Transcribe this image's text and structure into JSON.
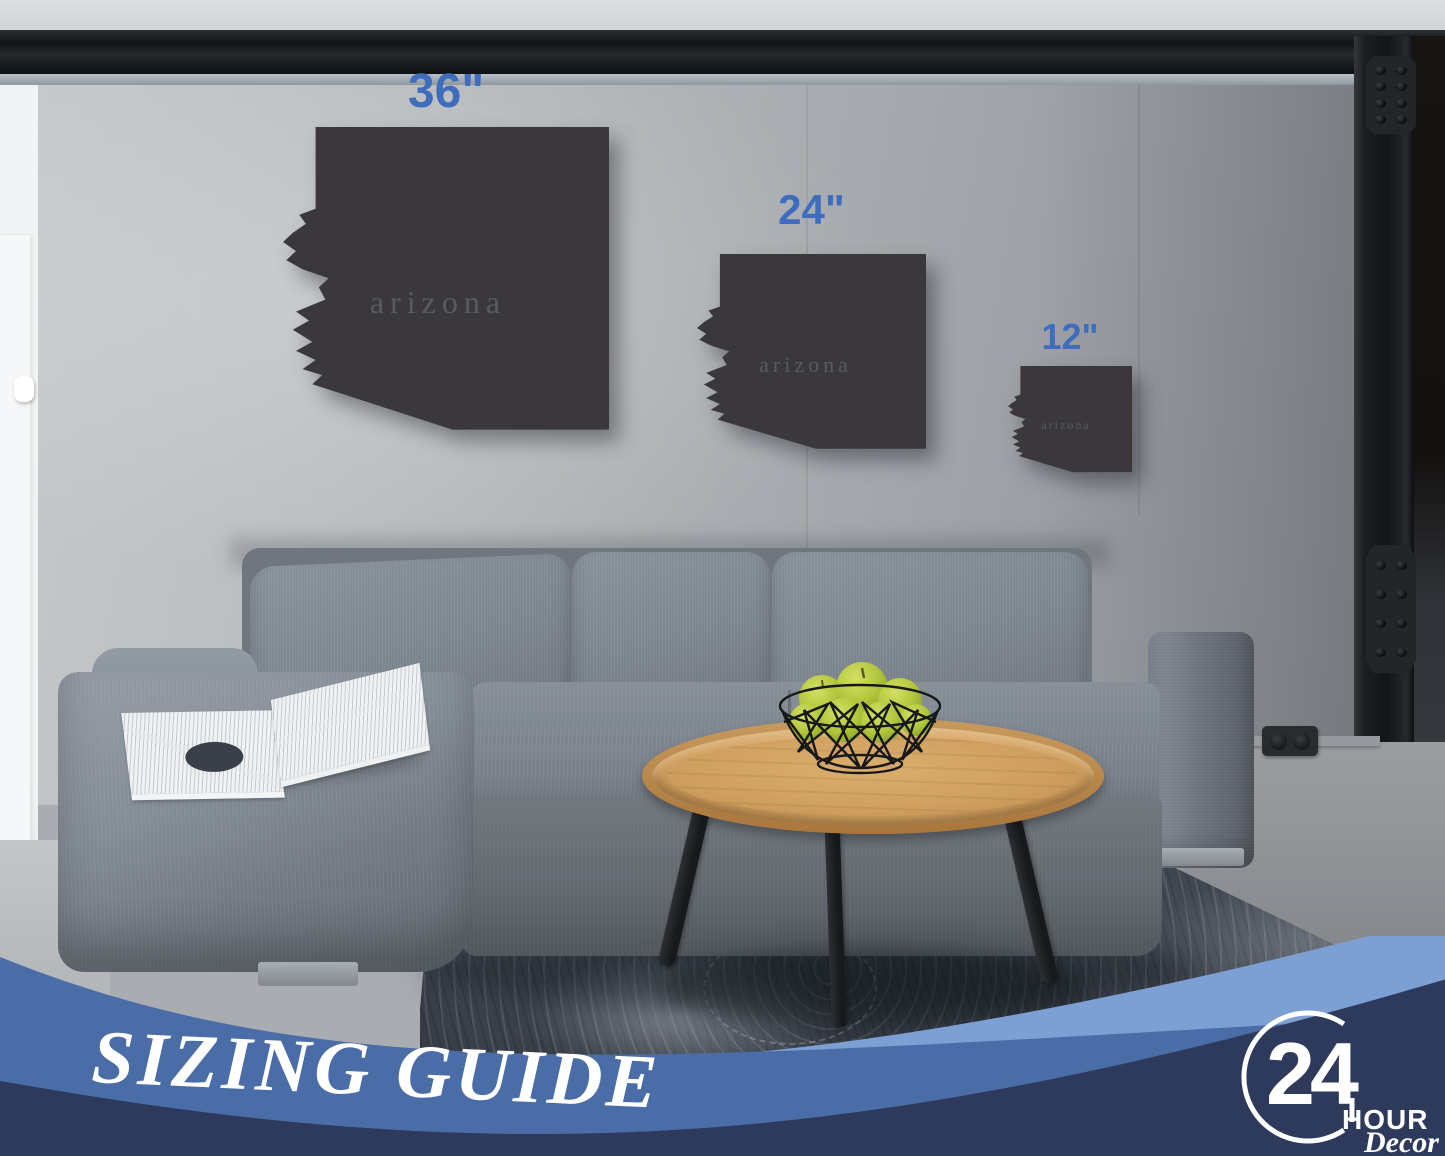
{
  "product": {
    "state_name": "arizona",
    "sizes": [
      {
        "label": "36\""
      },
      {
        "label": "24\""
      },
      {
        "label": "12\""
      }
    ]
  },
  "banner": {
    "title": "SIZING GUIDE"
  },
  "logo": {
    "number": "24",
    "word_hour": "HOUR",
    "word_decor": "Decor"
  },
  "colors": {
    "size_label_blue": "#3f6dbd",
    "cutout_charcoal": "#3a383a",
    "state_text_gray": "#5c5a61",
    "banner_light_blue": "#7ca0d4",
    "banner_mid_blue": "#4a6da8",
    "banner_navy": "#2e3a5c",
    "logo_white": "#ffffff"
  }
}
